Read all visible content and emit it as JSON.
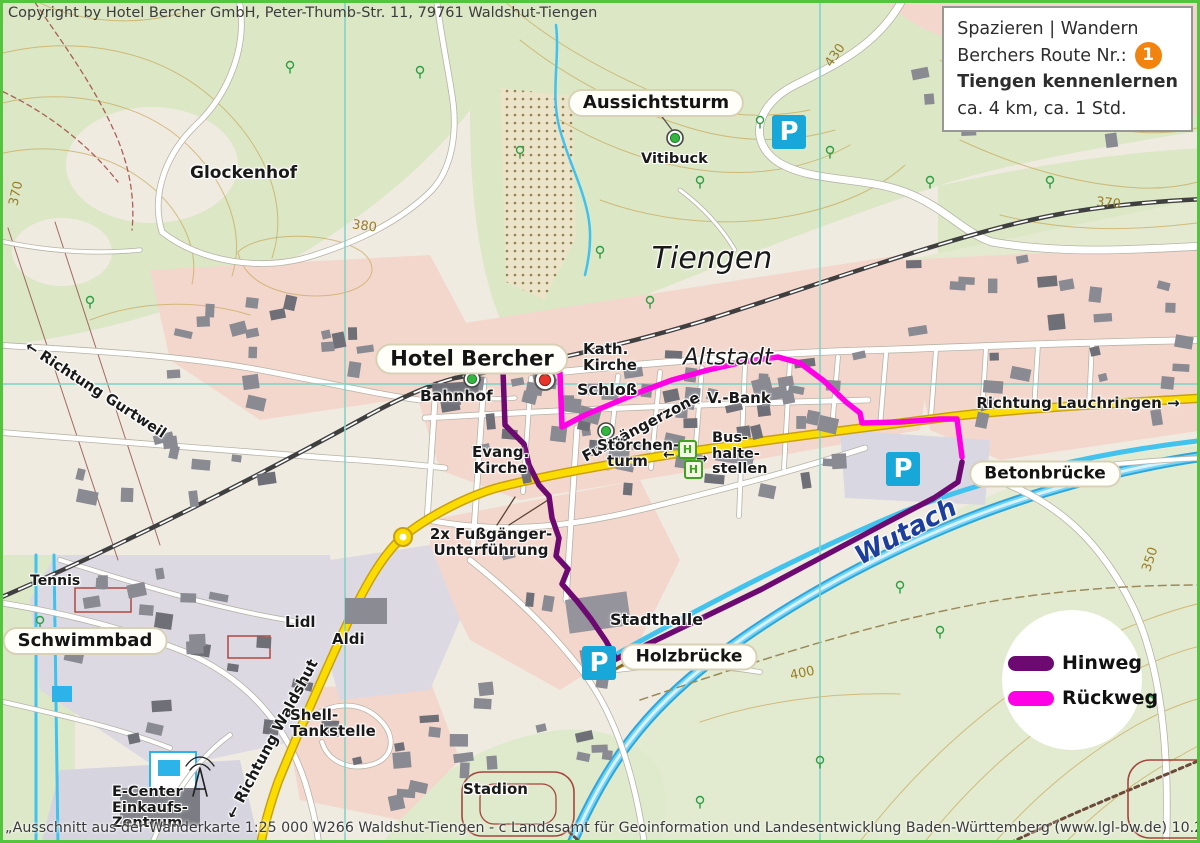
{
  "copyright": "Copyright by Hotel Bercher GmbH, Peter-Thumb-Str. 11, 79761 Waldshut-Tiengen",
  "infobox": {
    "line1": "Spazieren | Wandern",
    "line2": "Berchers Route Nr.:",
    "badge": "1",
    "title": "Tiengen kennenlernen",
    "line4": "ca. 4 km, ca. 1 Std."
  },
  "legend": {
    "hinweg": "Hinweg",
    "rueckweg": "Rückweg"
  },
  "attribution": "„Ausschnitt aus der Wanderkarte 1:25 000 W266 Waldshut-Tiengen - c Landesamt für Geoinformation und Landesentwicklung Baden-Württemberg (www.lgl-bw.de) 10.2019, Az.:2851.2-D/9955.“",
  "places": {
    "glockenhof": "Glockenhof",
    "aussichtsturm": "Aussichtsturm",
    "vitibuck": "Vitibuck",
    "tiengen": "Tiengen",
    "altstadt": "Altstadt",
    "hotel_bercher": "Hotel Bercher",
    "kath_kirche_1": "Kath.",
    "kath_kirche_2": "Kirche",
    "schloss": "Schloß",
    "bahnhof": "Bahnhof",
    "evang_kirche_1": "Evang.",
    "evang_kirche_2": "Kirche",
    "fussgaengerzone": "Fußgängerzone",
    "v_bank": "V.-Bank",
    "stoerchenturm_1": "Störchen-",
    "stoerchenturm_2": "turm",
    "bus_1": "Bus-",
    "bus_2": "halte-",
    "bus_3": "stellen",
    "richtung_lauchringen": "Richtung Lauchringen →",
    "richtung_gurtweil": "← Richtung Gurtweil",
    "richtung_waldshut": "← Richtung Waldshut",
    "betonbruecke": "Betonbrücke",
    "wutach": "Wutach",
    "unterfuehrung_1": "2x Fußgänger-",
    "unterfuehrung_2": "Unterführung",
    "tennis": "Tennis",
    "schwimmbad": "Schwimmbad",
    "lidl": "Lidl",
    "aldi": "Aldi",
    "stadthalle": "Stadthalle",
    "holzbruecke": "Holzbrücke",
    "shell_1": "Shell-",
    "shell_2": "Tankstelle",
    "e_center_1": "E-Center",
    "e_center_2": "Einkaufs-",
    "e_center_3": "Zentrum",
    "stadion": "Stadion"
  },
  "symbols": {
    "parking": "P",
    "bus_stop": "H",
    "arrow_left": "←",
    "arrow_right": "→"
  },
  "contour_labels": {
    "c370_nw": "370",
    "c380": "380",
    "c430": "430",
    "c370_ne": "370",
    "c400": "400",
    "c350": "350"
  },
  "colors": {
    "hinweg": "#6c0a72",
    "rueckweg": "#ff00e6",
    "parking_blue": "#18a7d9",
    "route_badge_orange": "#f2830f",
    "main_road_yellow": "#fbdc00",
    "water_blue": "#41c3ee"
  }
}
